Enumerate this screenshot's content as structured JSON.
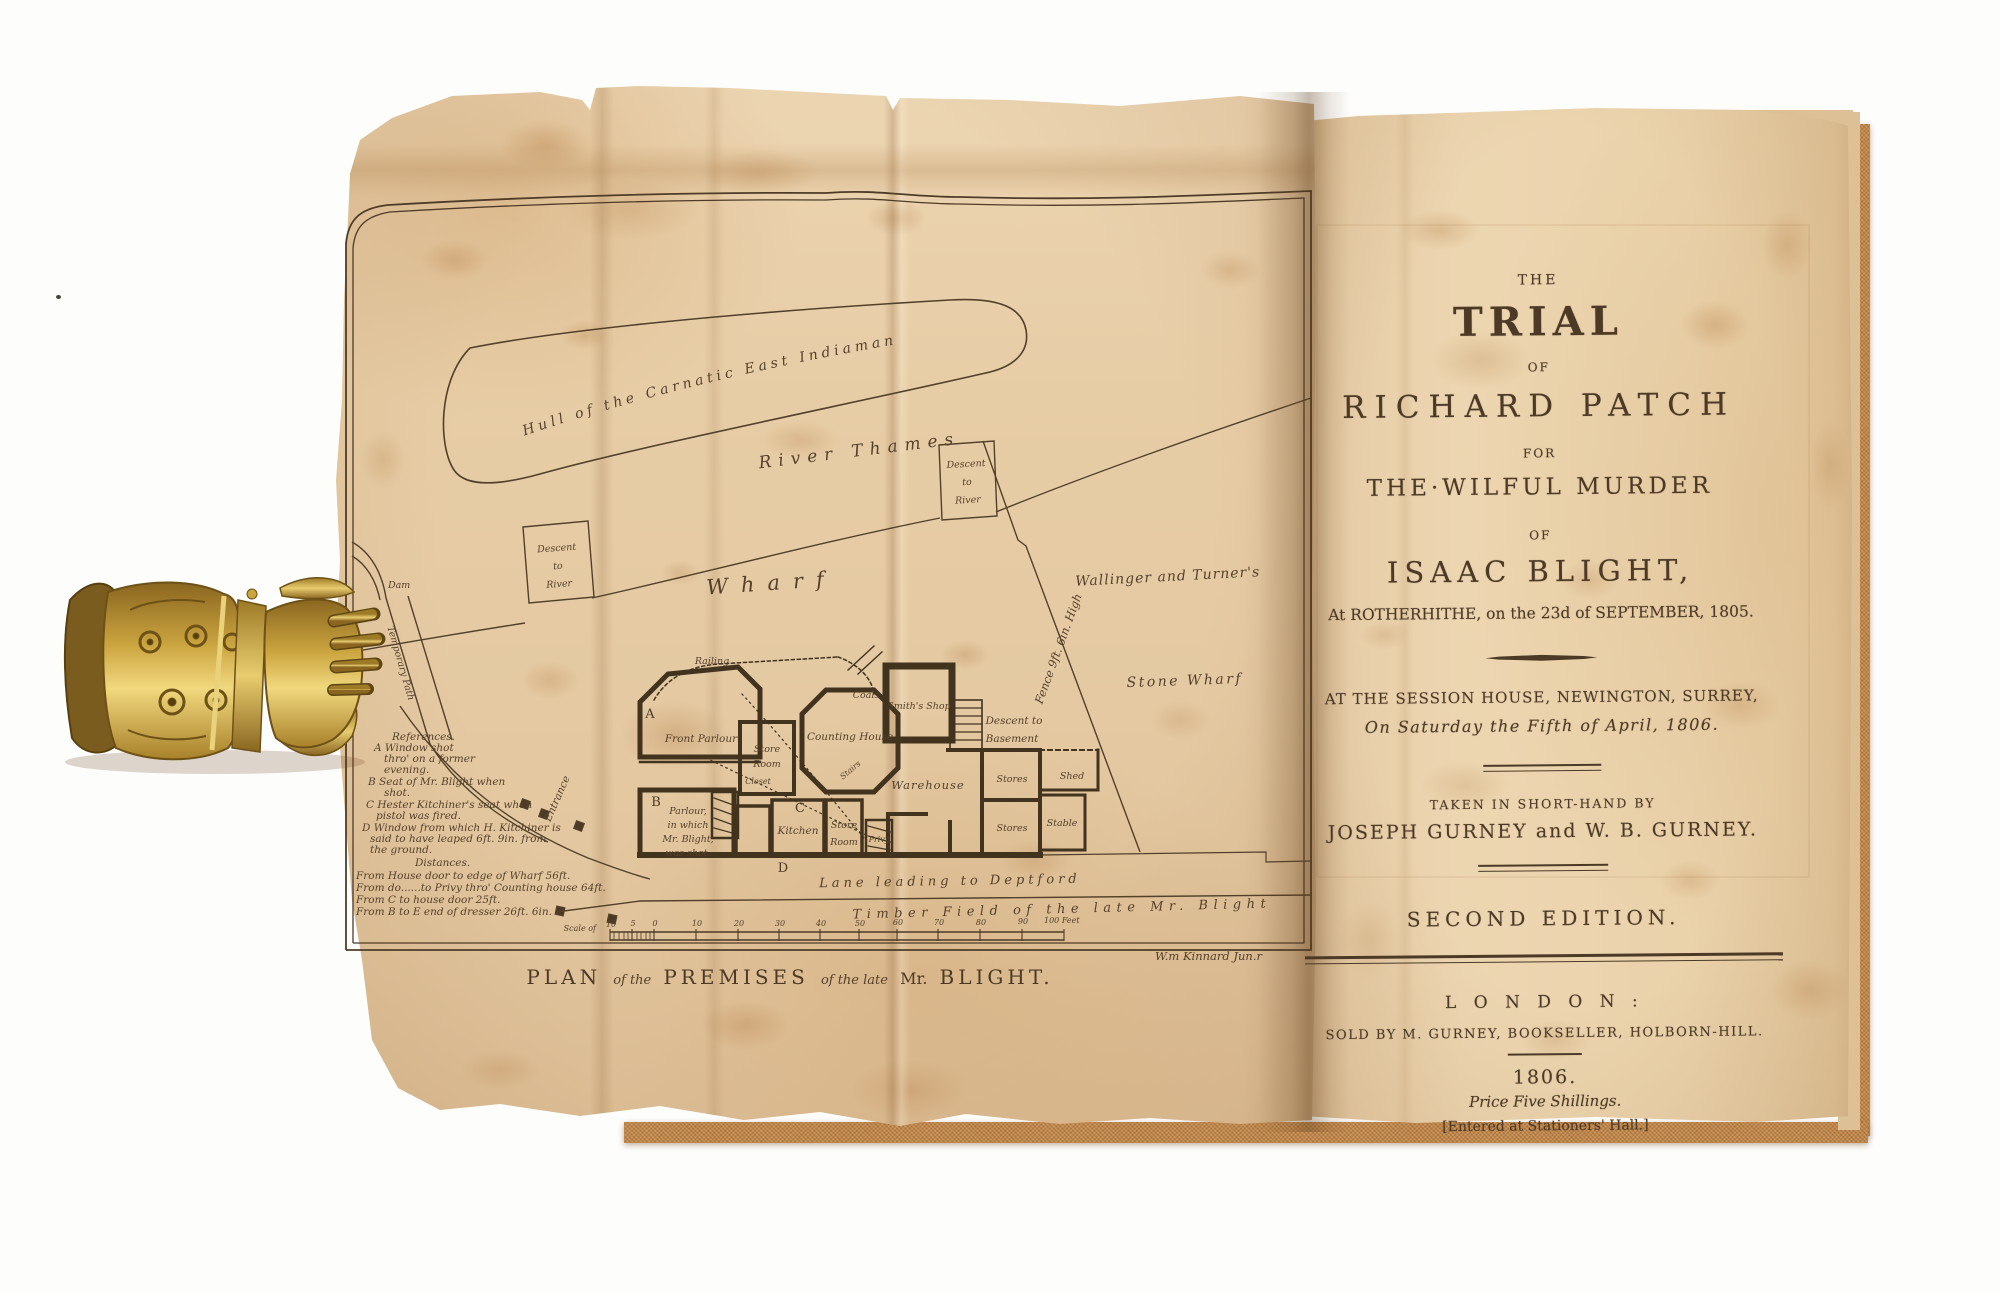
{
  "palette": {
    "paper": "#e7cda6",
    "cover_cloth": "#bf8449",
    "engraving_ink": "#55412b",
    "letterpress_ink": "#4c3a27",
    "brass_clasp": "#d9b552"
  },
  "plate": {
    "labels": {
      "hull": "Hull of the Carnatic East Indiaman",
      "river": "River Thames",
      "descent1": [
        "Descent",
        "to",
        "River"
      ],
      "descent2": [
        "Descent",
        "to",
        "River"
      ],
      "wharf": "Wharf",
      "dam": "Dam",
      "temporary_path": "Temporary Path",
      "entrance": "Entrance",
      "wallinger": "Wallinger and Turner's",
      "stone_wharf": "Stone Wharf",
      "fence": "Fence 9ft. 6in. High",
      "railing": "Railing",
      "marker_a": "A",
      "marker_b": "B",
      "marker_c": "C",
      "marker_d": "D",
      "front_parlour": "Front Parlour",
      "store_room_upper": [
        "Store",
        "Room"
      ],
      "closet_upper": "Closet",
      "closet_lower": "Closet",
      "counting_house": "Counting House",
      "coals": "Coals",
      "smiths_shop": "Smith's Shop",
      "stairs": "Stairs",
      "descent_basement": [
        "Descent to",
        "Basement"
      ],
      "warehouse": "Warehouse",
      "stores_upper": "Stores",
      "stores_lower": "Stores",
      "shed": "Shed",
      "stable": "Stable",
      "parlour_shot": [
        "Parlour,",
        "in which",
        "Mr. Blight,",
        "was shot."
      ],
      "kitchen": "Kitchen",
      "store_room_lower": [
        "Store",
        "Room"
      ],
      "privy": "Privy",
      "lane": "Lane leading to Deptford",
      "timber_field": "Timber Field of the late Mr. Blight"
    },
    "legend": [
      "References.",
      "A Window shot",
      "thro' on a former",
      "evening.",
      "B Seat of Mr. Blight when",
      "shot.",
      "C Hester Kitchiner's seat when",
      "pistol was fired.",
      "D Window from which H. Kitchiner is",
      "said to have leaped 6ft. 9in. from",
      "the ground.",
      "Distances.",
      "From House door to edge of Wharf 56ft.",
      "From do......to Privy thro' Counting house 64ft.",
      "From C to house door 25ft.",
      "From B to E end of dresser 26ft. 6in."
    ],
    "scale": {
      "label": "Scale of",
      "numbers": [
        "10",
        "5",
        "0",
        "10",
        "20",
        "30",
        "40",
        "50",
        "60",
        "70",
        "80",
        "90"
      ],
      "end": "100 Feet"
    },
    "caption_parts": [
      "PLAN",
      "of the",
      "PREMISES",
      "of the late",
      "Mr.",
      "BLIGHT."
    ],
    "signature": "W.m Kinnard Jun.r"
  },
  "title_page": {
    "the": "THE",
    "trial": "TRIAL",
    "of_1": "OF",
    "defendant": "RICHARD PATCH",
    "for": "FOR",
    "charge": "THE·WILFUL MURDER",
    "of_2": "OF",
    "victim": "ISAAC BLIGHT,",
    "location_date": "At ROTHERHITHE, on the 23d of SEPTEMBER, 1805.",
    "court": "AT THE SESSION HOUSE, NEWINGTON, SURREY,",
    "trial_date": "On Saturday the Fifth of April, 1806.",
    "shorthand_note": "TAKEN IN SHORT-HAND BY",
    "reporters": "JOSEPH GURNEY and W. B. GURNEY.",
    "edition": "SECOND EDITION.",
    "city": "L O N D O N :",
    "publisher": "SOLD BY M. GURNEY, BOOKSELLER, HOLBORN-HILL.",
    "year": "1806.",
    "price": "Price Five Shillings.",
    "registration": "[Entered at Stationers' Hall.]"
  }
}
